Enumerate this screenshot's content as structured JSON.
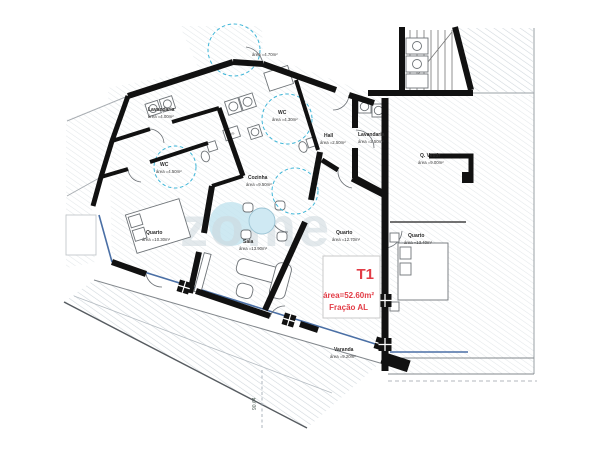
{
  "meta": {
    "watermark": "zome",
    "drawing_type": "apartment-floor-plan"
  },
  "unit": {
    "code": "T1",
    "area": "área=52.60m²",
    "fraction": "Fração AL"
  },
  "rooms": [
    {
      "name": "Lavandaria",
      "area": "área =4.00m²"
    },
    {
      "name": "WC",
      "area": "área =4.50m²"
    },
    {
      "name": "WC",
      "area": "área =4.30m²"
    },
    {
      "name": "Hall",
      "area": "área =2.50m²"
    },
    {
      "name": "Lavandaria",
      "area": "área =2.50m²"
    },
    {
      "name": "Cozinha",
      "area": "área =9.50m²"
    },
    {
      "name": "Quarto",
      "area": "área =10.30m²"
    },
    {
      "name": "Sala",
      "area": "área =13.90m²"
    },
    {
      "name": "Quarto",
      "area": "área =12.70m²"
    },
    {
      "name": "Quarto",
      "area": "área =13.40m²"
    },
    {
      "name": "Q. Vestir",
      "area": "área =9.00m²"
    },
    {
      "name": "Varanda",
      "area": "área =9.20m²"
    },
    {
      "name": "",
      "area": "área =4.70m²"
    }
  ],
  "annotations": {
    "dimension": "90.64",
    "appliance": "FRIG"
  },
  "colors": {
    "wall": "#111111",
    "glass": "#4a6fa5",
    "turning_circle": "#3fb6d8",
    "accent_red": "#e23c46",
    "hatch": "#dde2e6",
    "watermark_gray": "#cdd8de",
    "watermark_blue": "#c2e3ef"
  }
}
